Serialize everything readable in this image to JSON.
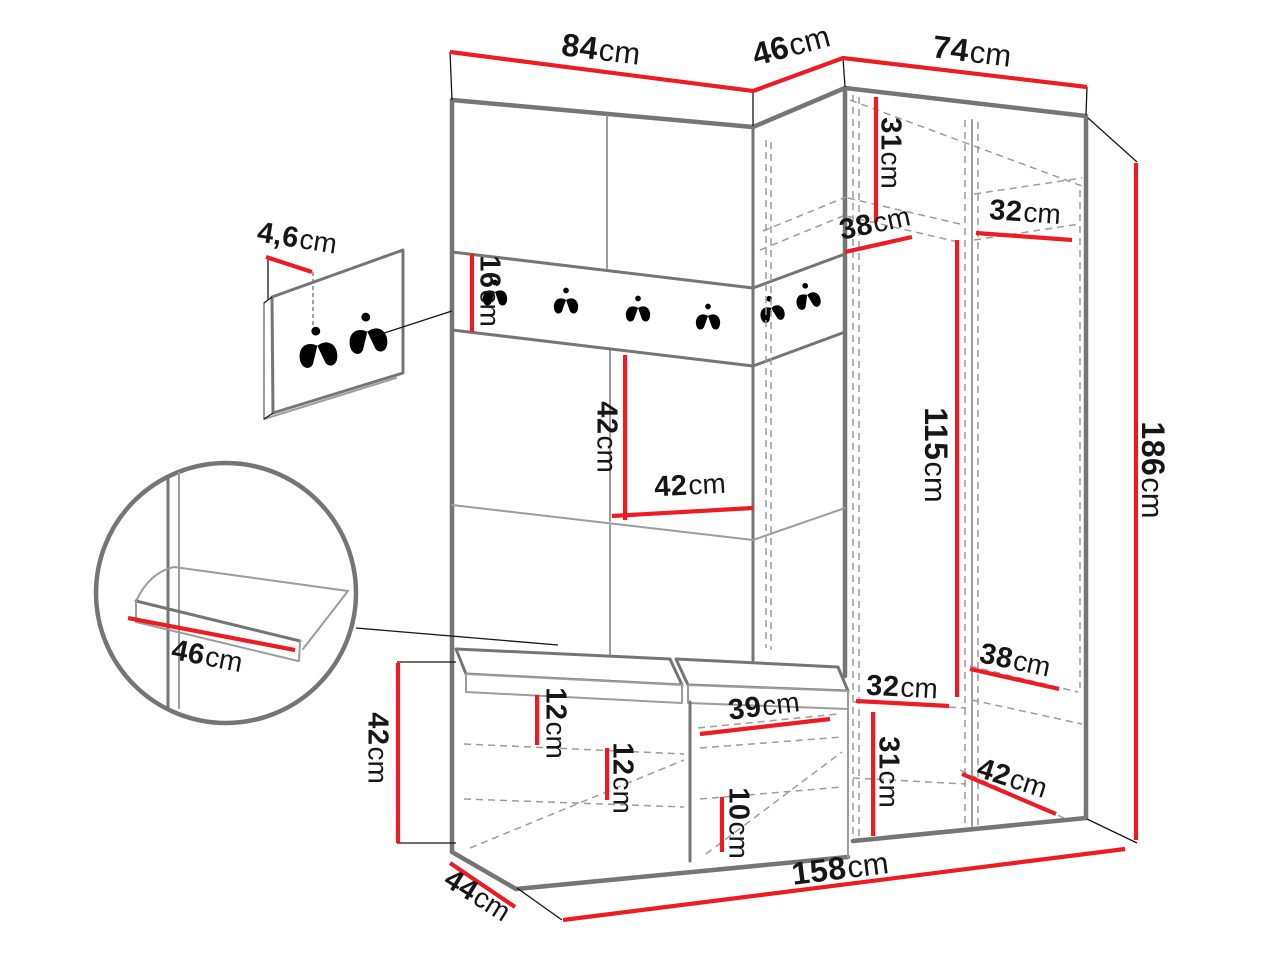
{
  "diagram": {
    "kind": "furniture dimension drawing",
    "subject": "hallway wardrobe set with coat hook rail, corner cabinet, tall wardrobe and shoe bench",
    "units": "cm"
  },
  "colors": {
    "background": "#ffffff",
    "outline_dark": "#757575",
    "outline_light": "#9c9c9c",
    "dimension_red": "#ed1c24",
    "text_black": "#161616"
  },
  "dimensions": {
    "top_left_width": {
      "value": "84",
      "unit": "cm"
    },
    "corner_depth": {
      "value": "46",
      "unit": "cm"
    },
    "top_right_width": {
      "value": "74",
      "unit": "cm"
    },
    "hook_panel_thickness": {
      "value": "4,6",
      "unit": "cm"
    },
    "hook_rail_height": {
      "value": "16",
      "unit": "cm"
    },
    "upper_shelf_height": {
      "value": "31",
      "unit": "cm"
    },
    "upper_shelf_depth": {
      "value": "38",
      "unit": "cm"
    },
    "upper_shelf_width": {
      "value": "32",
      "unit": "cm"
    },
    "middle_panel_height": {
      "value": "42",
      "unit": "cm"
    },
    "middle_panel_width": {
      "value": "42",
      "unit": "cm"
    },
    "hanging_height": {
      "value": "115",
      "unit": "cm"
    },
    "total_height": {
      "value": "186",
      "unit": "cm"
    },
    "seat_depth": {
      "value": "46",
      "unit": "cm"
    },
    "bench_height": {
      "value": "42",
      "unit": "cm"
    },
    "cushion_thickness": {
      "value": "12",
      "unit": "cm"
    },
    "shelf_spacing": {
      "value": "12",
      "unit": "cm"
    },
    "compartment_width": {
      "value": "39",
      "unit": "cm"
    },
    "bottom_shelf_height": {
      "value": "10",
      "unit": "cm"
    },
    "lower_shelf_width": {
      "value": "32",
      "unit": "cm"
    },
    "lower_shelf_depth": {
      "value": "38",
      "unit": "cm"
    },
    "lower_section_height": {
      "value": "31",
      "unit": "cm"
    },
    "lower_shelf_diagonal": {
      "value": "42",
      "unit": "cm"
    },
    "total_width": {
      "value": "158",
      "unit": "cm"
    },
    "bench_depth": {
      "value": "44",
      "unit": "cm"
    }
  }
}
